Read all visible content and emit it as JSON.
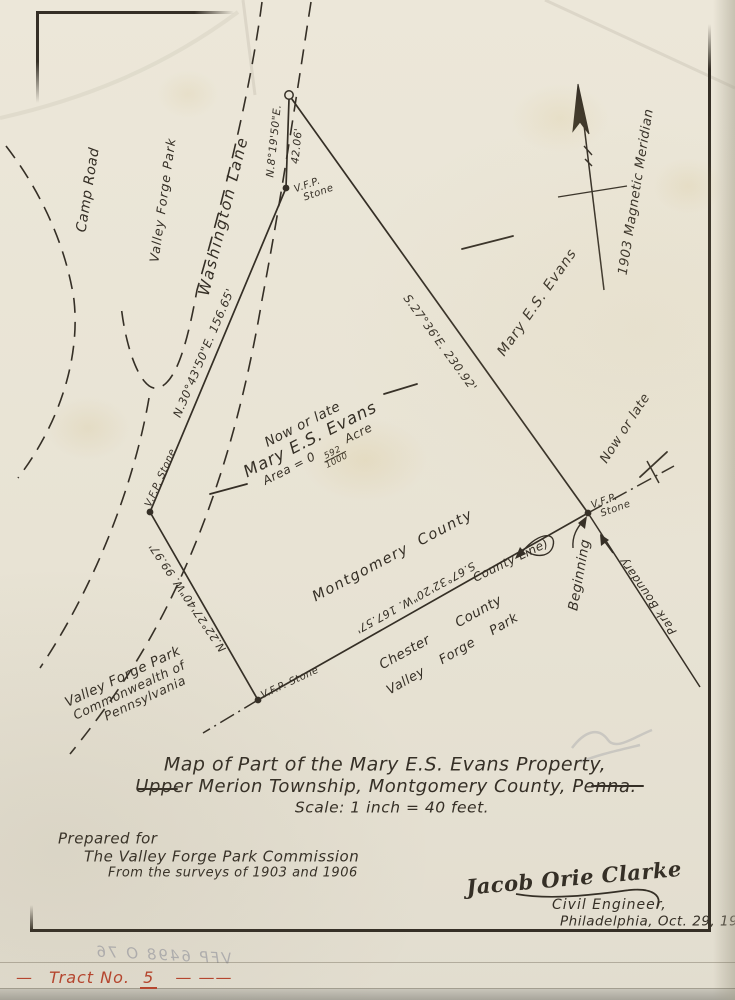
{
  "document": {
    "title_line1": "Map of Part of the Mary E.S. Evans Property,",
    "title_line2": "Upper Merion Township, Montgomery County, Penna.",
    "title_line3": "Scale: 1 inch = 40 feet.",
    "prepared_line1": "Prepared for",
    "prepared_line2": "The Valley Forge Park Commission",
    "prepared_line3": "From the surveys of 1903 and 1906",
    "signature_name": "Jacob Orie Clarke",
    "signature_title": "Civil Engineer,",
    "signature_place_date": "Philadelphia, Oct. 29, 1915",
    "tract_prefix": "—",
    "tract_label": "Tract No.",
    "tract_number": "5",
    "tract_suffix": "— ——",
    "pencil_showthrough": "VFP 6498 O 76"
  },
  "map": {
    "north_label": "1903 Magnetic Meridian",
    "roads": {
      "washington_lane": "Washington Lane",
      "camp_road": "Camp Road",
      "valley_forge_park": "Valley Forge Park"
    },
    "parcel": {
      "owner_prefix": "Now or late",
      "owner_name": "Mary E.S. Evans",
      "area_label": "Area = 0",
      "area_numerator": "592",
      "area_denominator": "1000",
      "area_unit": "Acre"
    },
    "neighbor_east": {
      "prefix": "Now or late",
      "name": "Mary E.S. Evans"
    },
    "bearings": {
      "north_segment": "N.8°19'50\"E.",
      "north_segment_distance": "42.06'",
      "west_upper": "N.30°43'50\"E. 156.65'",
      "east_long": "S.27°36'E. 230.92'",
      "west_lower": "N.22°27'40\"W. 99.97'",
      "county_line": "S.67°32'20\"W. 167.57'"
    },
    "counties": {
      "north": "Montgomery County",
      "south": "Chester County",
      "line_label": "County Line)"
    },
    "park_south": "Valley Forge Park",
    "commonwealth_line1": "Valley Forge Park",
    "commonwealth_line2": "Commonwealth of",
    "commonwealth_line3": "Pennsylvania",
    "markers": {
      "vfp": "V.F.P.",
      "stone": "Stone",
      "vfp_stone": "V.F.P. Stone",
      "beginning": "Beginning",
      "park_boundary": "Park Boundary"
    }
  },
  "colors": {
    "paper": "#e9e4d6",
    "ink": "#352f26",
    "red_annotation": "#b5462f"
  }
}
